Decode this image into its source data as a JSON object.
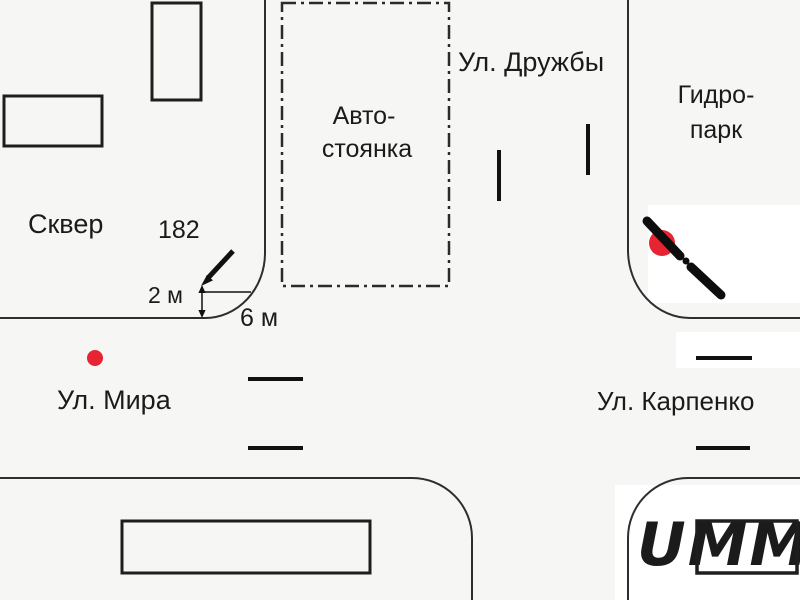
{
  "diagram": {
    "type": "traffic-accident-intersection-scheme",
    "background_color": "#f6f6f5",
    "line_color": "#2e2e2e",
    "areas": {
      "square_label": "Сквер",
      "parking_line1": "Авто-",
      "parking_line2": "стоянка",
      "hydropark_line1": "Гидро-",
      "hydropark_line2": "парк"
    },
    "streets": {
      "north": "Ул. Дружбы",
      "west": "Ул. Мира",
      "east": "Ул. Карпенко"
    },
    "measurements": {
      "building_number": "182",
      "dim_small": "2 м",
      "dim_large": "6 м"
    },
    "markers": {
      "accident_color": "#e62433",
      "impact_icon": "red-dot",
      "vehicle_icon": "motorcycle-diagonal-bar"
    },
    "watermark": {
      "text": "UMM",
      "color": "#d5d7ea"
    }
  }
}
